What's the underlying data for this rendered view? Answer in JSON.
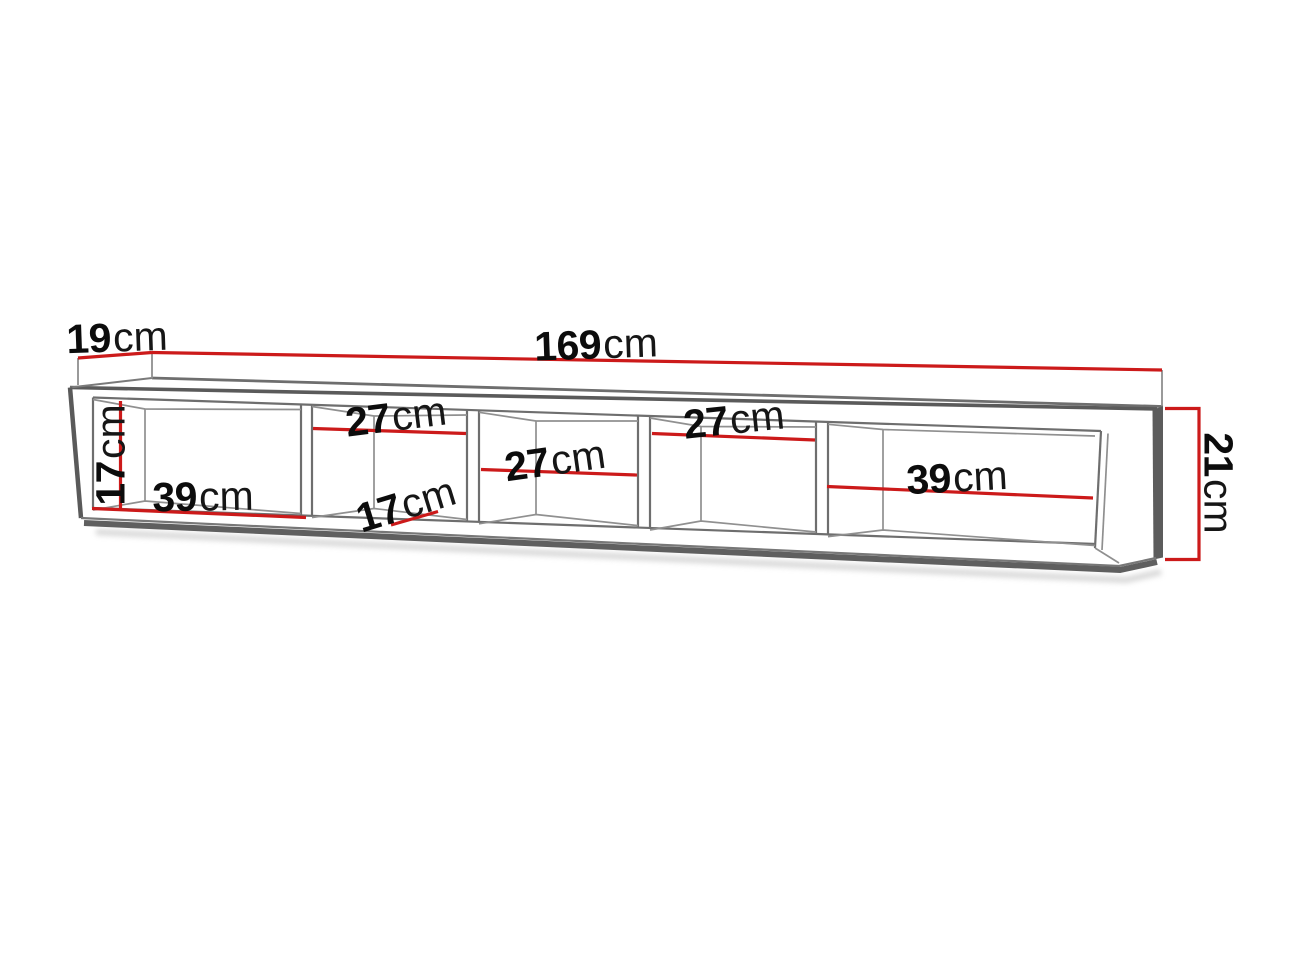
{
  "diagram": {
    "type": "furniture-dimension-drawing",
    "subject": "wall-mounted shelf with five open compartments",
    "unit": "cm",
    "colors": {
      "background": "#ffffff",
      "dimension_red": "#cc1a1a",
      "outline_dark": "#5a5a5a",
      "outline_mid": "#6e6e6e",
      "interior_line": "#909090",
      "shadow": "#cdcdcd",
      "text": "#0c0c0c"
    },
    "dims": {
      "depth": {
        "num": "19",
        "unit": "cm"
      },
      "width": {
        "num": "169",
        "unit": "cm"
      },
      "height": {
        "num": "21",
        "unit": "cm"
      },
      "interior_height": {
        "num": "17",
        "unit": "cm"
      },
      "interior_depth": {
        "num": "17",
        "unit": "cm"
      },
      "compartment_1": {
        "num": "39",
        "unit": "cm"
      },
      "compartment_2": {
        "num": "27",
        "unit": "cm"
      },
      "compartment_3": {
        "num": "27",
        "unit": "cm"
      },
      "compartment_4": {
        "num": "27",
        "unit": "cm"
      },
      "compartment_5": {
        "num": "39",
        "unit": "cm"
      }
    }
  }
}
